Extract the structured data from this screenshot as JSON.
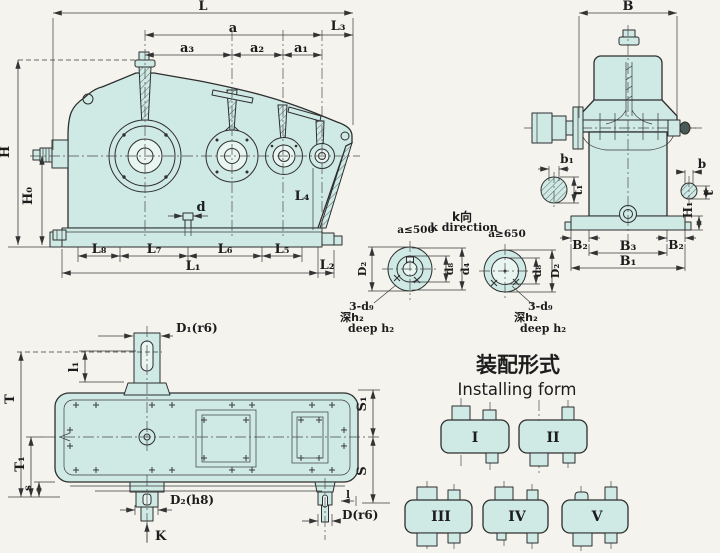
{
  "colors": {
    "background": "#f4f3ee",
    "body_fill": "#cfe9e4",
    "line": "#2e2e2e"
  },
  "front_view": {
    "labels": {
      "L": "L",
      "a": "a",
      "a3": "a₃",
      "a2": "a₂",
      "a1": "a₁",
      "L3": "L₃",
      "H": "H",
      "H0": "H₀",
      "d": "d",
      "L4": "L₄",
      "L8": "L₈",
      "L7": "L₇",
      "L6": "L₆",
      "L5": "L₅",
      "L1": "L₁",
      "L2": "L₂"
    }
  },
  "side_view": {
    "labels": {
      "B": "B",
      "b1": "b₁",
      "t1": "t₁",
      "b": "b",
      "t": "t",
      "H1": "H₁",
      "B2_left": "B₂",
      "B2_right": "B₂",
      "B3": "B₃",
      "B1": "B₁"
    }
  },
  "k_view": {
    "title_cn": "k向",
    "title_en": "k direction",
    "left": {
      "condition": "a≤500",
      "D2": "D₂",
      "d8": "d₈",
      "d4": "d₄",
      "holes": "3-d₉",
      "depth_cn": "深h₂",
      "depth_en": "deep h₂"
    },
    "right": {
      "condition": "a≥650",
      "d8": "d₈",
      "D2": "D₂",
      "holes": "3-d₉",
      "depth_cn": "深h₂",
      "depth_en": "deep h₂"
    }
  },
  "plan_view": {
    "labels": {
      "D1": "D₁(r6)",
      "l1": "l₁",
      "T": "T",
      "T1": "T₁",
      "s": "s",
      "S1": "S₁",
      "S": "S",
      "D2h8": "D₂(h8)",
      "K": "K",
      "l": "l",
      "D": "D(r6)"
    }
  },
  "installing": {
    "title_cn": "装配形式",
    "title_en": "Installing form",
    "forms": [
      {
        "label": "I"
      },
      {
        "label": "II"
      },
      {
        "label": "III"
      },
      {
        "label": "IV"
      },
      {
        "label": "V"
      }
    ]
  }
}
